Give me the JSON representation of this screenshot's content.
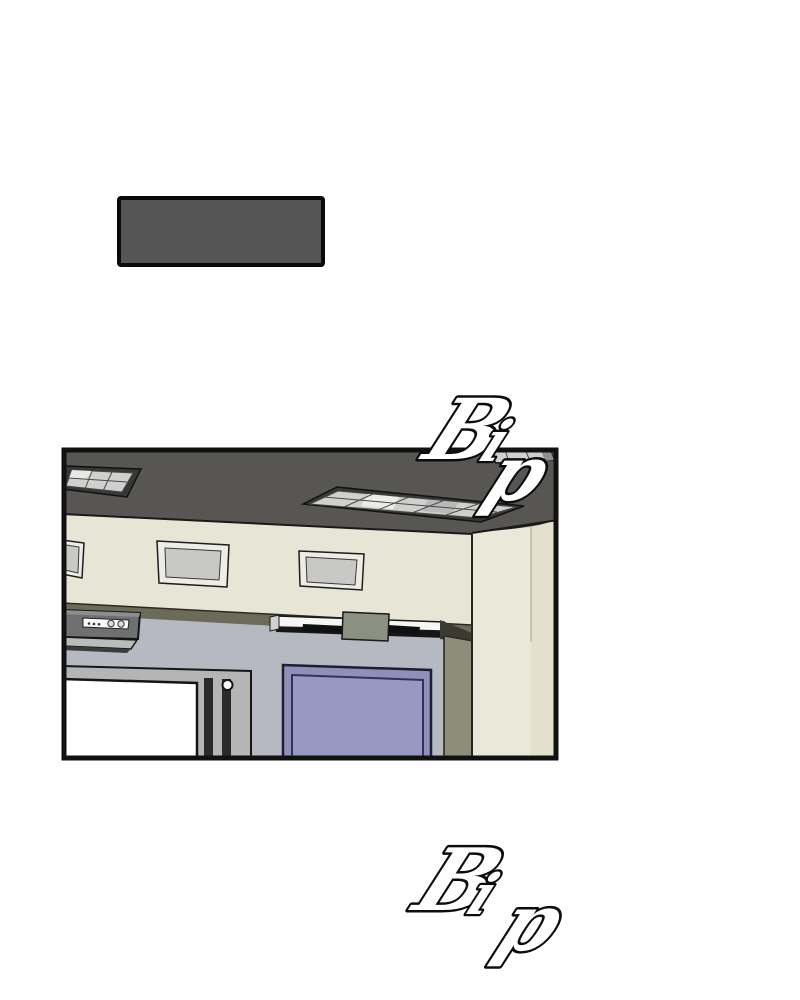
{
  "page": {
    "kind_label": "comic-panel-page"
  },
  "caption_box": {
    "text": ""
  },
  "sfx": {
    "top": {
      "text": "Bip",
      "letters": [
        "B",
        "i",
        "p"
      ]
    },
    "bottom": {
      "text": "Bip",
      "letters": [
        "B",
        "i",
        "p"
      ]
    }
  },
  "scene": {
    "objects": [
      "ceiling",
      "recessed-light-panel-left",
      "recessed-light-panel-center",
      "recessed-light-panel-right",
      "clerestory-window-left",
      "clerestory-window-middle",
      "clerestory-window-right",
      "air-conditioner",
      "fluorescent-light",
      "whiteboard",
      "purple-door",
      "wall-column"
    ]
  },
  "colors": {
    "page_bg": "#ffffff",
    "caption_fill": "#555555",
    "caption_stroke": "#0a0a0a",
    "panel_stroke": "#111111",
    "ceiling": "#585652",
    "wall_beige": "#e7e5d5",
    "olive_band": "#6c6a58",
    "wall_blue": "#b6b9c1",
    "column_green": "#8e8d7a",
    "column_beige": "#eae8d8",
    "wall_right": "#e3e0ce",
    "door_frame": "#8e90ba",
    "door_panel": "#9799c2",
    "board_frame": "#b5b5b5",
    "board_surface": "#ffffff",
    "fixture_frame": "#383838",
    "fixture_cell": "#d0d0ce",
    "ac_body": "#6e7072",
    "mount_green": "#8b9180",
    "sfx_fill": "#ffffff",
    "sfx_stroke": "#0c0c0c"
  }
}
